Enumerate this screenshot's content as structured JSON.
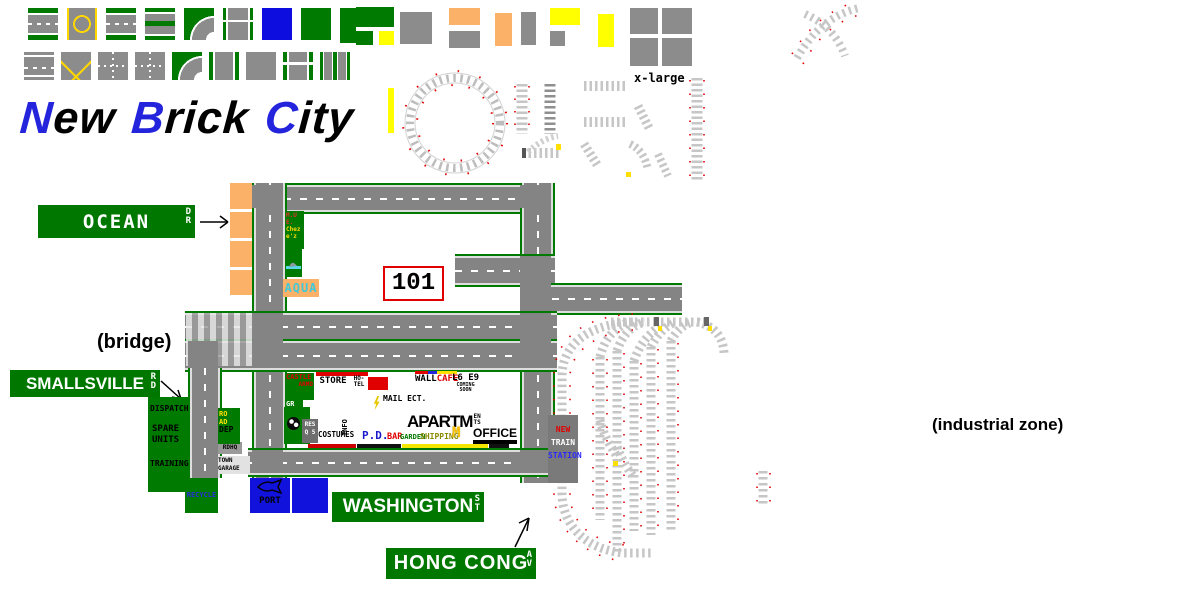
{
  "title": {
    "words": [
      {
        "lead": "N",
        "rest": "ew"
      },
      {
        "lead": "B",
        "rest": "rick"
      },
      {
        "lead": "C",
        "rest": "ity"
      }
    ]
  },
  "palette": {
    "row1": [
      "road-straight-h",
      "road-cross-roundabout",
      "road-straight-dash",
      "road-straight-median",
      "road-curve",
      "road-t-junction",
      "water-plate",
      "park-plate",
      "park-plate-tall"
    ],
    "row2": [
      "road-straight-h2",
      "road-t-yellow",
      "road-junction-small",
      "road-cross-walks",
      "road-curve2",
      "road-straight-v",
      "road-t-left",
      "road-v-crosswalk",
      "road-v-double"
    ],
    "blocks": [
      "gray-large",
      "orange-flat",
      "gray-flat",
      "orange-tall",
      "gray-tall",
      "yellow-flat",
      "gray-small",
      "yellow-tall",
      "xlarge-plate",
      "green-wide",
      "green-small",
      "yellow-small",
      "yellow-sliver"
    ]
  },
  "labels": {
    "x_large": "x-large",
    "bridge": "(bridge)",
    "industrial_zone": "(industrial zone)",
    "highway_101": "101"
  },
  "signs": {
    "ocean": {
      "name": "OCEAN",
      "suffix": [
        "D",
        "R"
      ]
    },
    "smallsville": {
      "name": "SMALLSVILLE",
      "suffix": [
        "R",
        "D"
      ]
    },
    "washington": {
      "name": "WASHINGTON",
      "suffix": [
        "S",
        "T"
      ]
    },
    "hong_cong": {
      "name": "HONG CONG",
      "suffix": [
        "A",
        "V"
      ]
    }
  },
  "oceanfront": {
    "chez_lines": [
      "M.U",
      "E.",
      "Chez",
      "e'z"
    ],
    "aqua": "AQUA"
  },
  "buildings": {
    "castle": "CASTLE",
    "castle_sub": "ARMD",
    "grill_lines": [
      "GR",
      "ILL"
    ],
    "store": "STORE",
    "hotel_lines": [
      "HO-",
      "TEL"
    ],
    "mail": "MAIL ECT.",
    "wall": "WALL",
    "cafe": "CAFE",
    "coming_lines": [
      "L6 E9",
      "COMING",
      "SOON"
    ],
    "res_lines": [
      "RES",
      "Q 5"
    ],
    "costumes": "COSTUMES",
    "info": "INFO",
    "police": "P.D.",
    "bar": "BAR",
    "garden": "GARDEN",
    "shipping": "SHIPPING",
    "apartments_main": "APARTM",
    "apartments_stack": [
      "EN",
      "TS"
    ],
    "mcdonalds_m": "M",
    "office": "OFFICE"
  },
  "station_lines": [
    "NEW",
    "TRAIN",
    "STATION"
  ],
  "municipal": {
    "dispatch": "DISPATCH",
    "spare": "SPARE",
    "units": "UNITS",
    "training": "TRAINING",
    "road_dep_lines": [
      "RO",
      "AD",
      "DEP"
    ],
    "hq": "RDHQ",
    "garage_lines": [
      "TOWN",
      "GARAGE"
    ],
    "recycle": "RECYCLE",
    "port": "PORT"
  },
  "colors": {
    "sign_green": "#007800",
    "stripe_green": "#007a00",
    "road_gray": "#848484",
    "water_blue": "#1212dd",
    "beach_orange": "#fbb168",
    "accent_yellow": "#ffff00",
    "title_blue": "#2424dd",
    "alert_red": "#e00000"
  }
}
